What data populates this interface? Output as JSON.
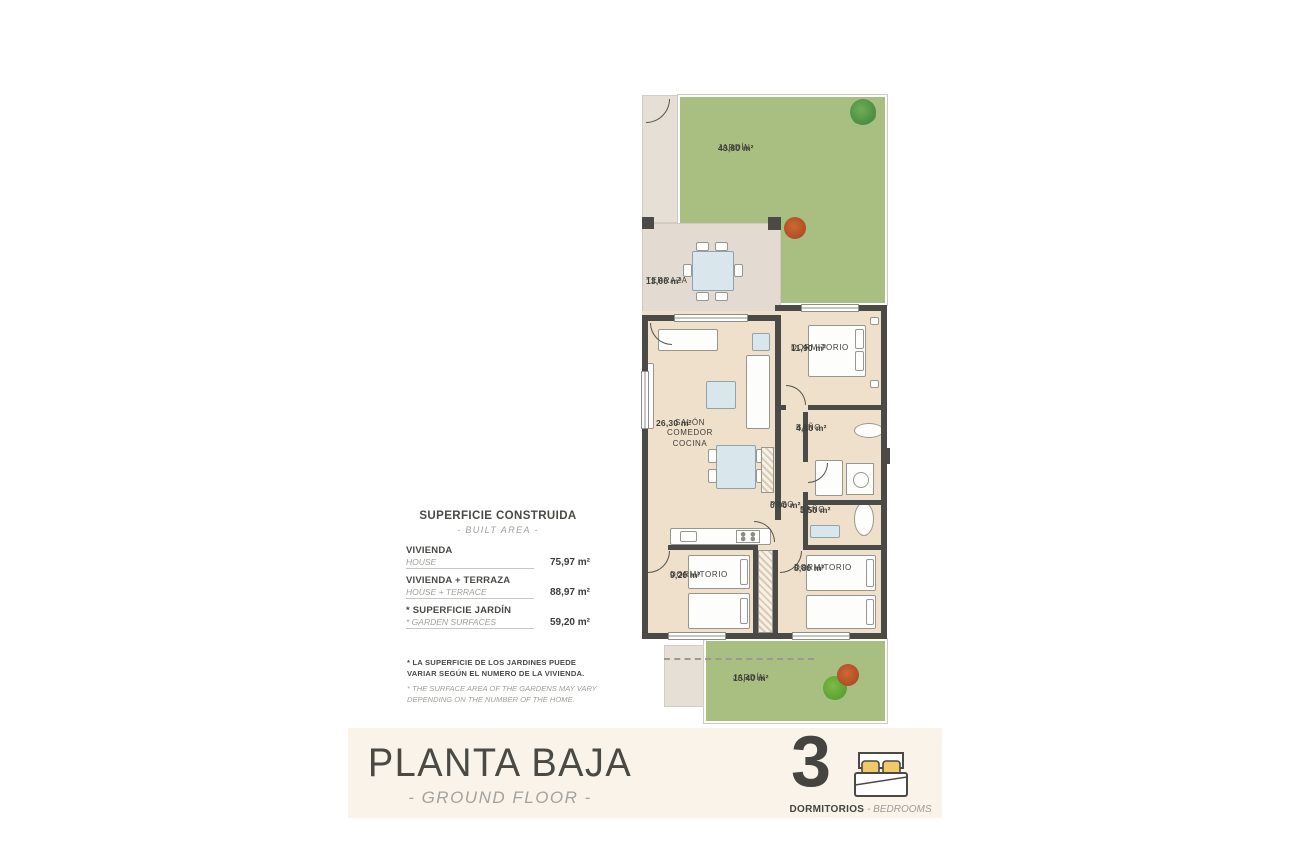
{
  "plan": {
    "rooms": {
      "garden_top": {
        "name": "JARDÍN",
        "area": "43,80 m²"
      },
      "terrace": {
        "name": "TERRAZA",
        "area": "13,00 m²"
      },
      "living": {
        "name": "SALÓN COMEDOR COCINA",
        "area": "26,30 m²"
      },
      "bedroom1": {
        "name": "DORMITORIO",
        "area": "11,90 m²"
      },
      "bath1": {
        "name": "BAÑO",
        "area": "4,10 m²"
      },
      "paso": {
        "name": "PASO",
        "area": "0,90 m²"
      },
      "bath2": {
        "name": "BAÑO",
        "area": "3,50 m²"
      },
      "bedroom2": {
        "name": "DORMITORIO",
        "area": "9,20 m²"
      },
      "bedroom3": {
        "name": "DORMITORIO",
        "area": "8,80 m²"
      },
      "garden_bottom": {
        "name": "JARDÍN",
        "area": "15,40 m²"
      }
    }
  },
  "legend": {
    "title": "SUPERFICIE CONSTRUIDA",
    "subtitle": "- BUILT AREA -",
    "rows": [
      {
        "es": "VIVIENDA",
        "en": "HOUSE",
        "value": "75,97 m²"
      },
      {
        "es": "VIVIENDA + TERRAZA",
        "en": "HOUSE + TERRACE",
        "value": "88,97 m²"
      },
      {
        "es": "* SUPERFICIE JARDÍN",
        "en": "* GARDEN SURFACES",
        "value": "59,20 m²"
      }
    ]
  },
  "note": {
    "es": "* LA SUPERFICIE DE LOS JARDINES PUEDE VARIAR SEGÚN EL NUMERO DE LA VIVIENDA.",
    "en": "* THE SURFACE AREA OF THE GARDENS MAY VARY DEPENDING ON THE NUMBER OF THE HOME."
  },
  "footer": {
    "title": "PLANTA BAJA",
    "subtitle": "- GROUND FLOOR -",
    "bedrooms_number": "3",
    "bedrooms_label_es": "DORMITORIOS",
    "bedrooms_label_en": "- BEDROOMS"
  },
  "colors": {
    "wall": "#4b4a46",
    "garden_green": "#a9be81",
    "floor_beige": "#eee0ca",
    "terrace_tile": "#e3dbd1",
    "footer_cream": "#f9f3ea",
    "text_dark": "#454440",
    "text_gray": "#9c9b97",
    "pillow_yellow": "#f2c967",
    "glass_blue": "#d9e6ec"
  }
}
